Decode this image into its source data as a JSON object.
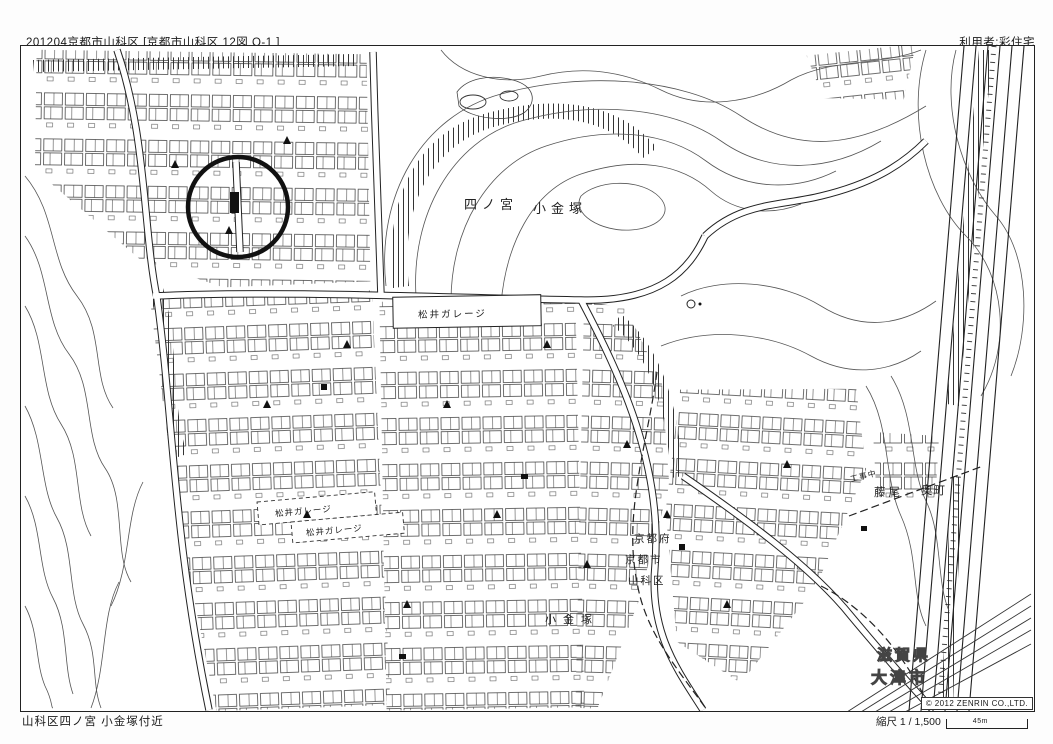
{
  "header": {
    "sheet_title": "201204京都市山科区 [京都市山科区 12図 O-1 ]",
    "user_label": "利用者:彩住宅"
  },
  "map": {
    "labels": {
      "hill_area_1": "四ノ宮",
      "hill_area_2": "小金塚",
      "garage_main": "松井ガレージ",
      "garage_2": "松井ガレージ",
      "garage_3": "松井ガレージ",
      "street": "小金塚",
      "boundary_pref": "京都府",
      "boundary_city": "京都市",
      "boundary_ward": "山科区",
      "district_fujio": "藤尾",
      "district_okumachi": "奥町",
      "construction": "工事中",
      "shiga_pref": "滋賀県",
      "otsu_city": "大津市"
    },
    "annotation": {
      "shape": "hand-drawn circle",
      "color": "#111111"
    }
  },
  "footer": {
    "area_name": "山科区四ノ宮 小金塚付近",
    "scale_label": "縮尺 1 / 1,500",
    "scale_distance": "45m",
    "copyright": "© 2012 ZENRIN CO.,LTD."
  },
  "colors": {
    "ink": "#1a1a1a",
    "contour": "#555555",
    "paper": "#ffffff"
  }
}
